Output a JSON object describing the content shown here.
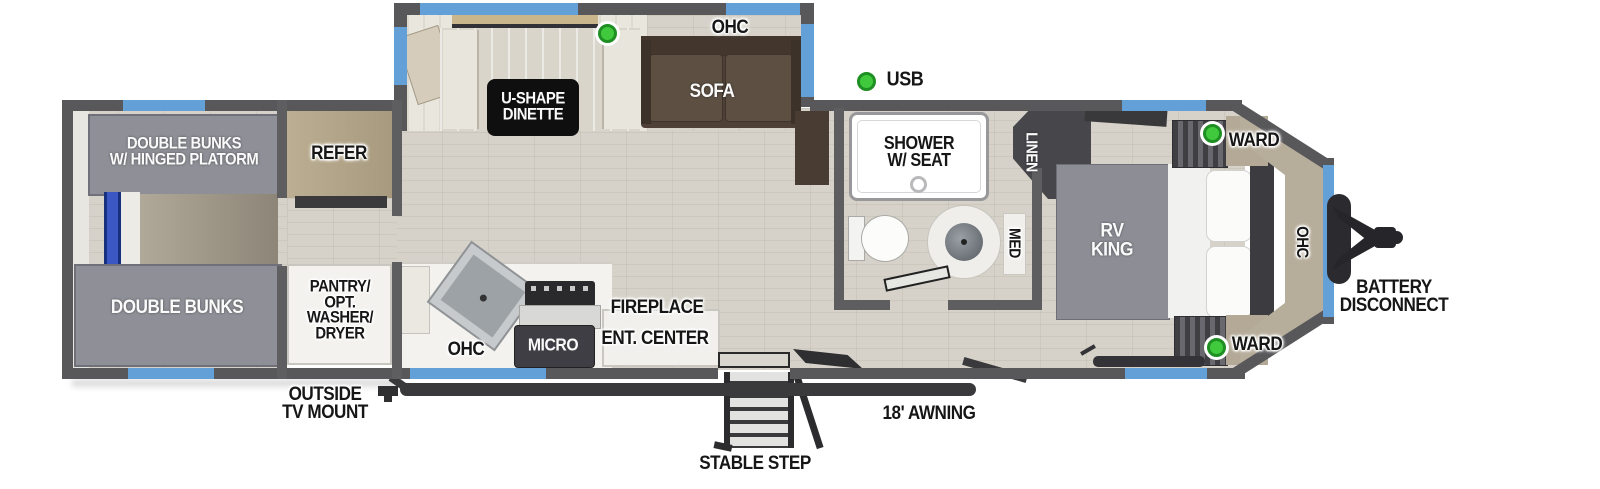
{
  "plan": {
    "rear_bunk_room": {
      "bunk_top_line1": "DOUBLE BUNKS",
      "bunk_top_line2": "W/ HINGED PLATORM",
      "bunk_bottom": "DOUBLE BUNKS"
    },
    "kitchen_area": {
      "refer": "REFER",
      "pantry_line1": "PANTRY/",
      "pantry_line2": "OPT.",
      "pantry_line3": "WASHER/",
      "pantry_line4": "DRYER",
      "ohc": "OHC",
      "micro": "MICRO",
      "fireplace": "FIREPLACE",
      "ent_center": "ENT. CENTER"
    },
    "slide_out": {
      "dinette_line1": "U-SHAPE",
      "dinette_line2": "DINETTE",
      "ohc": "OHC",
      "sofa": "SOFA"
    },
    "bathroom": {
      "shower_line1": "SHOWER",
      "shower_line2": "W/ SEAT",
      "linen": "LINEN",
      "med": "MED"
    },
    "bedroom": {
      "rv_king_line1": "RV",
      "rv_king_line2": "KING",
      "ward_top": "WARD",
      "ward_bottom": "WARD",
      "ohc_front": "OHC"
    },
    "exterior": {
      "usb": "USB",
      "outside_tv_line1": "OUTSIDE",
      "outside_tv_line2": "TV MOUNT",
      "stable_step": "STABLE STEP",
      "awning": "18' AWNING",
      "battery_line1": "BATTERY",
      "battery_line2": "DISCONNECT"
    }
  },
  "colors": {
    "wall": "#58585b",
    "window_blue": "#64a0d8",
    "indicator_green": "#41c93d",
    "floor_wood": "#d6d2c9",
    "sofa_brown": "#4e4036",
    "bunk_gray": "#8f8f97",
    "cap_beige": "#b7ad9b",
    "label_dark": "#161616"
  },
  "icons": {
    "green_dot": "led-indicator",
    "hitch": "trailer-hitch",
    "steps": "entry-steps"
  }
}
